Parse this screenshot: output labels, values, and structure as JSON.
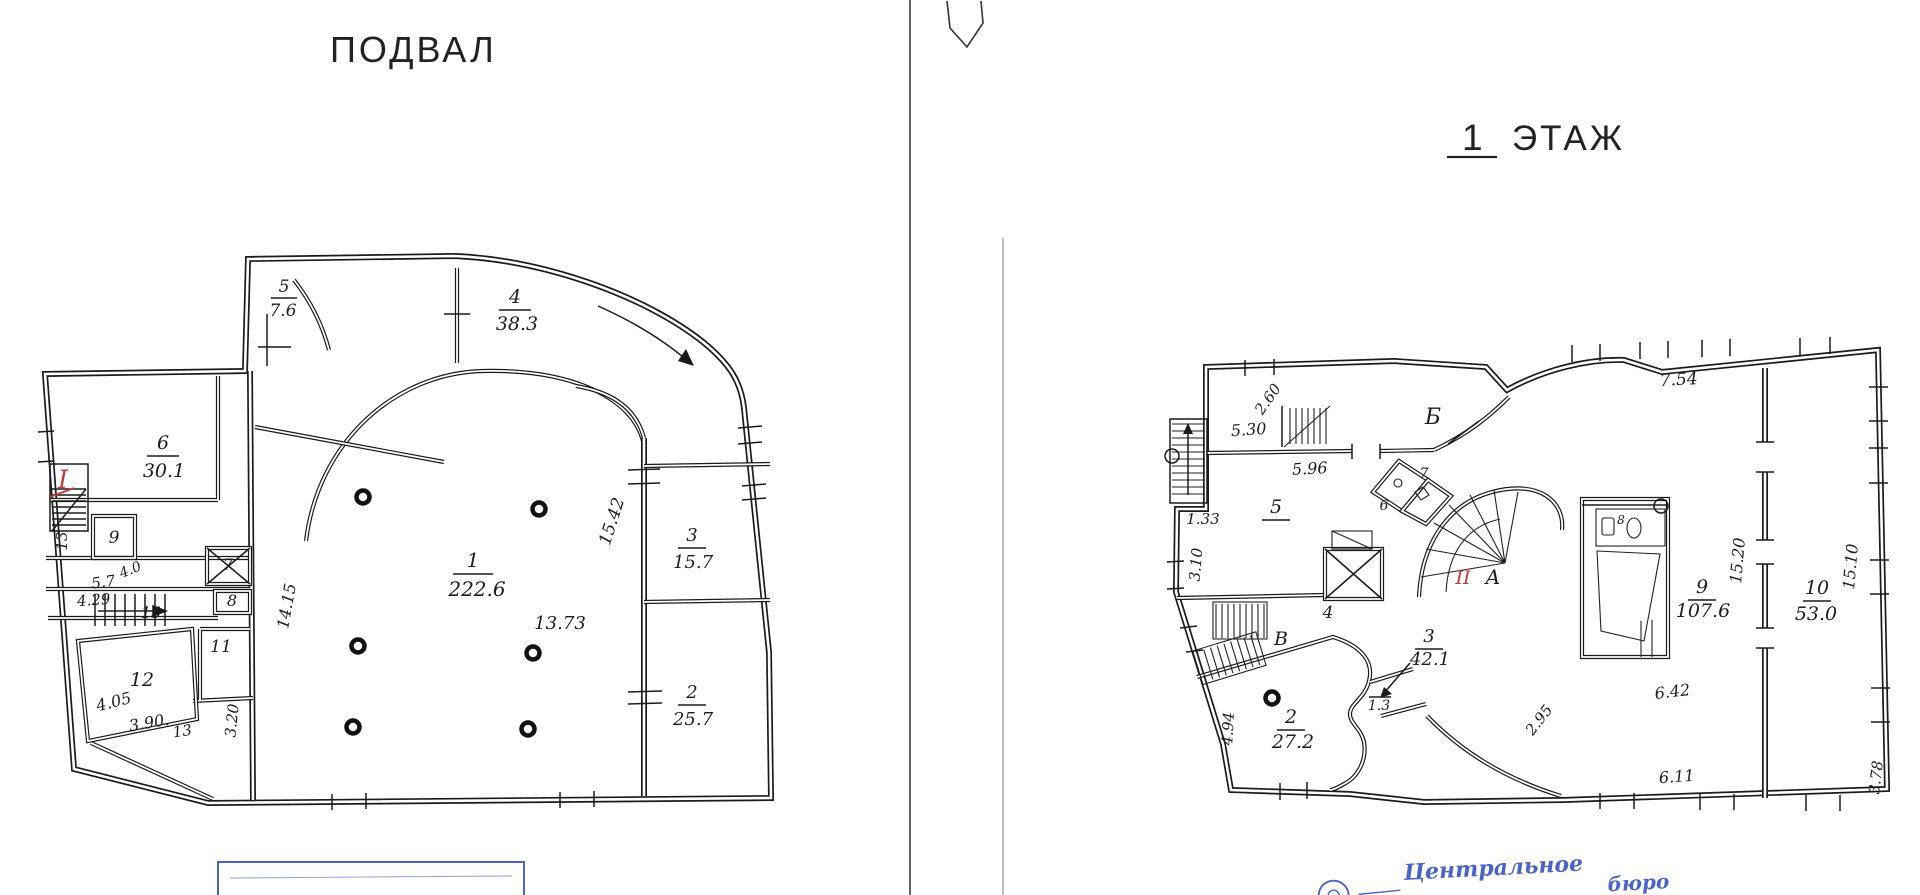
{
  "colors": {
    "ink": "#1c1c1c",
    "red_mark": "#c23b38",
    "stamp_blue": "#4a63c8",
    "paper": "#ffffff"
  },
  "basement": {
    "title": "ПОДВАЛ",
    "premise_mark": "I",
    "rooms": [
      {
        "num": "1",
        "area": "222.6"
      },
      {
        "num": "2",
        "area": "25.7"
      },
      {
        "num": "3",
        "area": "15.7"
      },
      {
        "num": "4",
        "area": "38.3"
      },
      {
        "num": "5",
        "area": "7.6"
      },
      {
        "num": "6",
        "area": "30.1"
      },
      {
        "num": "7"
      },
      {
        "num": "8"
      },
      {
        "num": "9"
      },
      {
        "num": "11"
      },
      {
        "num": "12"
      },
      {
        "num": "13"
      },
      {
        "num": "15"
      }
    ],
    "dimensions": {
      "d1373": "13.73",
      "d1542": "15.42",
      "d1415": "14.15",
      "d57": "5.7",
      "d40": "4.0",
      "d429": "4.29",
      "d405": "4.05",
      "d390": "3.90.",
      "d13": "13",
      "d320": "3.20"
    }
  },
  "floor1": {
    "title_number": "1",
    "title_word": "ЭТАЖ",
    "premise_mark": "II",
    "axis_letters": {
      "b": "Б",
      "v": "В",
      "a": "А"
    },
    "rooms": [
      {
        "num": "2",
        "area": "27.2"
      },
      {
        "num": "3",
        "area": "42.1"
      },
      {
        "num": "4"
      },
      {
        "num": "5"
      },
      {
        "num": "6"
      },
      {
        "num": "7"
      },
      {
        "num": "8"
      },
      {
        "num": "9",
        "area": "107.6"
      },
      {
        "num": "10",
        "area": "53.0"
      }
    ],
    "dimensions": {
      "d530": "5.30",
      "d260": "2.60",
      "d596": "5.96",
      "d133": "1.33",
      "d310": "3.10",
      "d494": "4.94",
      "d13": "1.3",
      "d295": "2.95",
      "d642": "6.42",
      "d611": "6.11",
      "d754": "7.54",
      "d1520": "15.20",
      "d1510": "15.10",
      "d378": "3.78"
    }
  },
  "stamp": {
    "word1": "Центральное",
    "word2": "бюро"
  }
}
